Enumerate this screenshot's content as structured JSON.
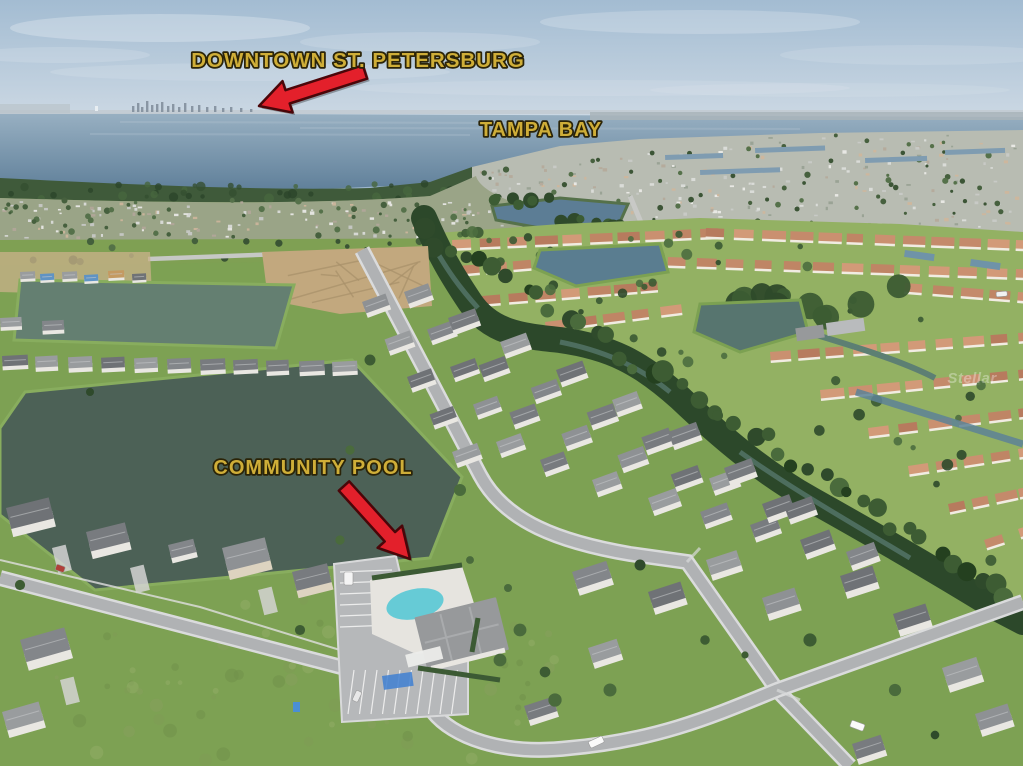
{
  "annotations": {
    "downtown_label": "DOWNTOWN ST. PETERSBURG",
    "tampa_bay_label": "TAMPA BAY",
    "community_pool_label": "COMMUNITY POOL",
    "watermark": "Stellar"
  },
  "colors": {
    "label_gold": "#cfae38",
    "label_outline": "#2b2408",
    "arrow_red": "#e3202b",
    "arrow_outline": "#4a0609",
    "sky_top": "#a3bcd2",
    "sky_horizon": "#cdd9e4",
    "bay_far": "#98b0c2",
    "bay_near": "#60809a",
    "pond_dark": "#4c6156",
    "pond_mid": "#647f71",
    "pond_blue": "#5c7d95",
    "pool": "#66cbd6",
    "terracotta_roof": "#c48a6b",
    "gray_roof": "#8a8d90",
    "grass": "#82a156",
    "lawn_bright": "#93b163",
    "tree_dark": "#2f4a2b",
    "road": "#b0b2b4",
    "dirt": "#c2a87e"
  }
}
